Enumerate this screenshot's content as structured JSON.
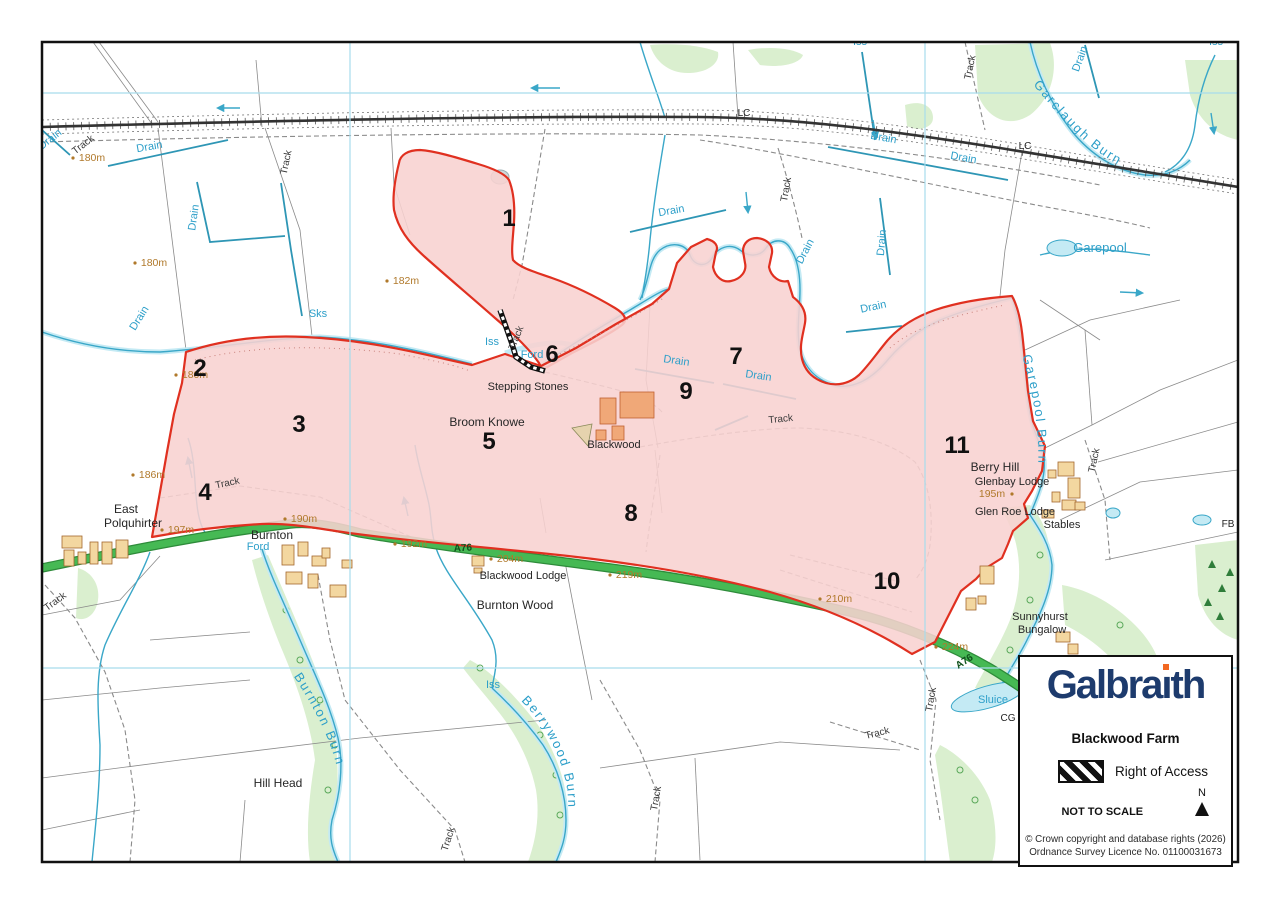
{
  "legend": {
    "brand": "Galbraith",
    "title": "Blackwood Farm",
    "right_of_access_label": "Right of Access",
    "not_to_scale": "NOT TO SCALE",
    "north_label": "N",
    "copyright_line1": "© Crown copyright and database rights (2026)",
    "copyright_line2": "Ordnance Survey Licence No. 01100031673",
    "brand_color": "#1d3b6d",
    "brand_dot_color": "#f26822"
  },
  "colors": {
    "parcel_fill": "#f8d2d0",
    "parcel_border": "#e03020",
    "road_green": "#46b954",
    "road_casing": "#2e8b3a",
    "water_line": "#3aa7c8",
    "water_fill": "#c4eaf4",
    "water_label": "#2d9fc9",
    "grid_line": "#a8dcec",
    "spot_height": "#b0792b",
    "building": "#f3d7a0",
    "building_farm": "#f0a878",
    "woodland": "#daefcf",
    "railway": "#333333"
  },
  "map": {
    "parcels": [
      {
        "id": "1",
        "x": 509,
        "y": 226
      },
      {
        "id": "2",
        "x": 200,
        "y": 376
      },
      {
        "id": "3",
        "x": 299,
        "y": 432
      },
      {
        "id": "4",
        "x": 205,
        "y": 500
      },
      {
        "id": "5",
        "x": 489,
        "y": 449
      },
      {
        "id": "6",
        "x": 552,
        "y": 362
      },
      {
        "id": "7",
        "x": 736,
        "y": 364
      },
      {
        "id": "8",
        "x": 631,
        "y": 521
      },
      {
        "id": "9",
        "x": 686,
        "y": 399
      },
      {
        "id": "10",
        "x": 887,
        "y": 589
      },
      {
        "id": "11",
        "x": 957,
        "y": 453
      }
    ],
    "burn_labels": [
      {
        "text": "Garclaugh Burn",
        "path": "bp1",
        "offset": 8
      },
      {
        "text": "Garepool Burn",
        "path": "bp2",
        "offset": 4
      },
      {
        "text": "Burnton Burn",
        "path": "bp3",
        "offset": 10
      },
      {
        "text": "Berrywood Burn",
        "path": "bp4",
        "offset": 4
      }
    ],
    "labels": [
      {
        "t": "Drain",
        "x": 52,
        "y": 142,
        "r": -38,
        "c": "water"
      },
      {
        "t": "Drain",
        "x": 150,
        "y": 150,
        "r": -10,
        "c": "water"
      },
      {
        "t": "Drain",
        "x": 197,
        "y": 218,
        "r": -82,
        "c": "water"
      },
      {
        "t": "Drain",
        "x": 142,
        "y": 320,
        "r": -58,
        "c": "water"
      },
      {
        "t": "Iss",
        "x": 860,
        "y": 45,
        "r": 0,
        "c": "water"
      },
      {
        "t": "Iss",
        "x": 1216,
        "y": 45,
        "r": 0,
        "c": "water"
      },
      {
        "t": "Drain",
        "x": 883,
        "y": 141,
        "r": 10,
        "c": "water"
      },
      {
        "t": "Drain",
        "x": 963,
        "y": 161,
        "r": 10,
        "c": "water"
      },
      {
        "t": "Drain",
        "x": 1083,
        "y": 60,
        "r": -70,
        "c": "water"
      },
      {
        "t": "Drain",
        "x": 672,
        "y": 214,
        "r": -10,
        "c": "water"
      },
      {
        "t": "Drain",
        "x": 808,
        "y": 253,
        "r": -62,
        "c": "water"
      },
      {
        "t": "Drain",
        "x": 885,
        "y": 243,
        "r": -85,
        "c": "water"
      },
      {
        "t": "Drain",
        "x": 874,
        "y": 310,
        "r": -12,
        "c": "water"
      },
      {
        "t": "Drain",
        "x": 676,
        "y": 364,
        "r": 8,
        "c": "water"
      },
      {
        "t": "Drain",
        "x": 758,
        "y": 379,
        "r": 8,
        "c": "water"
      },
      {
        "t": "Iss",
        "x": 492,
        "y": 345,
        "r": 0,
        "c": "water"
      },
      {
        "t": "Ford",
        "x": 532,
        "y": 358,
        "r": 0,
        "c": "water"
      },
      {
        "t": "Sks",
        "x": 318,
        "y": 317,
        "r": 0,
        "c": "water"
      },
      {
        "t": "Ford",
        "x": 258,
        "y": 550,
        "r": 0,
        "c": "water"
      },
      {
        "t": "Iss",
        "x": 493,
        "y": 688,
        "r": 0,
        "c": "water"
      },
      {
        "t": "Sluice",
        "x": 993,
        "y": 703,
        "r": 0,
        "c": "water"
      },
      {
        "t": "Garepool",
        "x": 1100,
        "y": 252,
        "r": 0,
        "c": "water-lg"
      },
      {
        "t": "Stepping Stones",
        "x": 528,
        "y": 390,
        "r": 0,
        "c": "place-sm"
      },
      {
        "t": "Broom Knowe",
        "x": 487,
        "y": 426,
        "r": 0,
        "c": "place"
      },
      {
        "t": "Blackwood",
        "x": 614,
        "y": 448,
        "r": 0,
        "c": "place-sm"
      },
      {
        "t": "East",
        "x": 126,
        "y": 513,
        "r": 0,
        "c": "place"
      },
      {
        "t": "Polquhirter",
        "x": 133,
        "y": 527,
        "r": 0,
        "c": "place"
      },
      {
        "t": "Burnton",
        "x": 272,
        "y": 539,
        "r": 0,
        "c": "place"
      },
      {
        "t": "Blackwood Lodge",
        "x": 523,
        "y": 579,
        "r": 0,
        "c": "place-sm"
      },
      {
        "t": "Burnton Wood",
        "x": 515,
        "y": 609,
        "r": 0,
        "c": "place"
      },
      {
        "t": "Hill Head",
        "x": 278,
        "y": 787,
        "r": 0,
        "c": "place"
      },
      {
        "t": "Berry Hill",
        "x": 995,
        "y": 471,
        "r": 0,
        "c": "place"
      },
      {
        "t": "Glenbay Lodge",
        "x": 1012,
        "y": 485,
        "r": 0,
        "c": "place-sm"
      },
      {
        "t": "Glen Roe Lodge",
        "x": 1015,
        "y": 515,
        "r": 0,
        "c": "place-sm"
      },
      {
        "t": "Stables",
        "x": 1062,
        "y": 528,
        "r": 0,
        "c": "place-sm"
      },
      {
        "t": "Sunnyhurst",
        "x": 1040,
        "y": 620,
        "r": 0,
        "c": "place-sm"
      },
      {
        "t": "Bungalow",
        "x": 1042,
        "y": 633,
        "r": 0,
        "c": "place-sm"
      },
      {
        "t": "LC",
        "x": 744,
        "y": 116,
        "r": 0,
        "c": "small-black"
      },
      {
        "t": "LC",
        "x": 1025,
        "y": 149,
        "r": 0,
        "c": "small-black"
      },
      {
        "t": "FB",
        "x": 1228,
        "y": 527,
        "r": 0,
        "c": "small-black"
      },
      {
        "t": "CG",
        "x": 1008,
        "y": 721,
        "r": 0,
        "c": "small-black"
      },
      {
        "t": "Track",
        "x": 85,
        "y": 147,
        "r": -38,
        "c": "track"
      },
      {
        "t": "Track",
        "x": 289,
        "y": 163,
        "r": -78,
        "c": "track"
      },
      {
        "t": "Track",
        "x": 973,
        "y": 68,
        "r": -78,
        "c": "track"
      },
      {
        "t": "Track",
        "x": 789,
        "y": 190,
        "r": -80,
        "c": "track"
      },
      {
        "t": "Track",
        "x": 519,
        "y": 339,
        "r": -68,
        "c": "track"
      },
      {
        "t": "Track",
        "x": 228,
        "y": 486,
        "r": -12,
        "c": "track"
      },
      {
        "t": "Track",
        "x": 781,
        "y": 422,
        "r": -6,
        "c": "track"
      },
      {
        "t": "Track",
        "x": 1097,
        "y": 461,
        "r": -78,
        "c": "track"
      },
      {
        "t": "Track",
        "x": 57,
        "y": 604,
        "r": -36,
        "c": "track"
      },
      {
        "t": "Track",
        "x": 934,
        "y": 700,
        "r": -80,
        "c": "track"
      },
      {
        "t": "Track",
        "x": 878,
        "y": 736,
        "r": -14,
        "c": "track"
      },
      {
        "t": "Track",
        "x": 451,
        "y": 840,
        "r": -72,
        "c": "track"
      },
      {
        "t": "Track",
        "x": 659,
        "y": 799,
        "r": -80,
        "c": "track"
      },
      {
        "t": "A76",
        "x": 463,
        "y": 551,
        "r": -3,
        "c": "road-lbl"
      },
      {
        "t": "A76",
        "x": 966,
        "y": 664,
        "r": -33,
        "c": "road-lbl"
      },
      {
        "t": "180m",
        "x": 92,
        "y": 161,
        "r": 0,
        "c": "spot",
        "dot": "left"
      },
      {
        "t": "180m",
        "x": 154,
        "y": 266,
        "r": 0,
        "c": "spot",
        "dot": "left"
      },
      {
        "t": "182m",
        "x": 406,
        "y": 284,
        "r": 0,
        "c": "spot",
        "dot": "left"
      },
      {
        "t": "180m",
        "x": 195,
        "y": 378,
        "r": 0,
        "c": "spot",
        "dot": "left"
      },
      {
        "t": "186m",
        "x": 152,
        "y": 478,
        "r": 0,
        "c": "spot",
        "dot": "left"
      },
      {
        "t": "197m",
        "x": 181,
        "y": 533,
        "r": 0,
        "c": "spot",
        "dot": "left"
      },
      {
        "t": "190m",
        "x": 304,
        "y": 522,
        "r": 0,
        "c": "spot",
        "dot": "left"
      },
      {
        "t": "192m",
        "x": 414,
        "y": 547,
        "r": 0,
        "c": "spot",
        "dot": "left"
      },
      {
        "t": "204m",
        "x": 510,
        "y": 562,
        "r": 0,
        "c": "spot",
        "dot": "left"
      },
      {
        "t": "219m",
        "x": 629,
        "y": 578,
        "r": 0,
        "c": "spot",
        "dot": "left"
      },
      {
        "t": "210m",
        "x": 839,
        "y": 602,
        "r": 0,
        "c": "spot",
        "dot": "left"
      },
      {
        "t": "224m",
        "x": 955,
        "y": 650,
        "r": 0,
        "c": "spot",
        "dot": "left"
      },
      {
        "t": "195m",
        "x": 992,
        "y": 497,
        "r": 0,
        "c": "spot",
        "dot": "right"
      }
    ]
  }
}
